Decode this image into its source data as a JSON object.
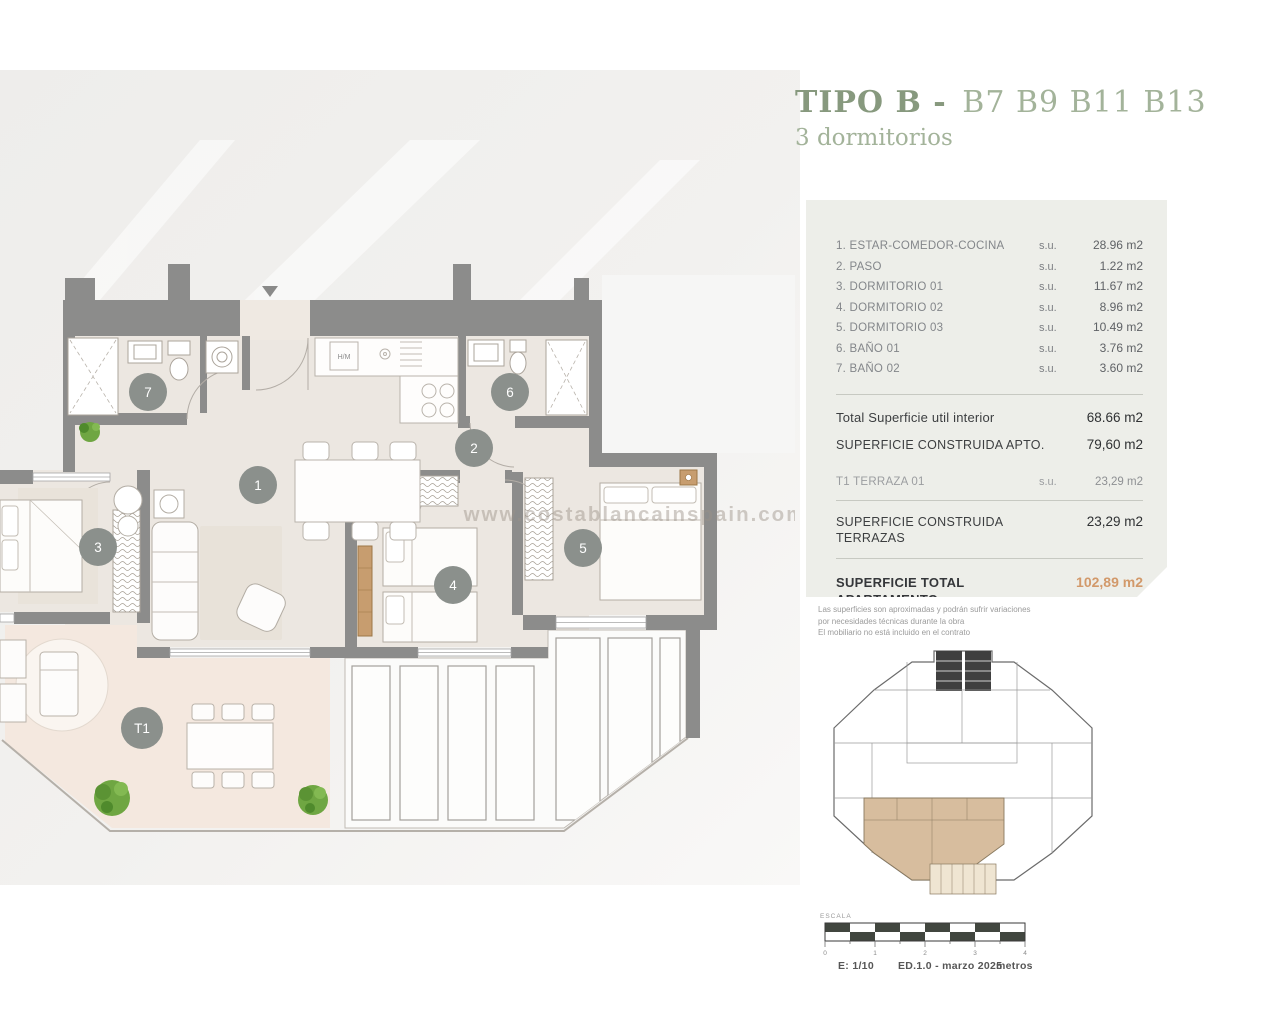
{
  "title": {
    "type_bold": "TIPO B -",
    "units": "B7 B9 B11 B13",
    "subtitle": "3 dormitorios"
  },
  "panel": {
    "rooms": [
      {
        "label": "1. ESTAR-COMEDOR-COCINA",
        "prefix": "s.u.",
        "value": "28.96 m2"
      },
      {
        "label": "2. PASO",
        "prefix": "s.u.",
        "value": "1.22 m2"
      },
      {
        "label": "3. DORMITORIO 01",
        "prefix": "s.u.",
        "value": "11.67 m2"
      },
      {
        "label": "4. DORMITORIO 02",
        "prefix": "s.u.",
        "value": "8.96 m2"
      },
      {
        "label": "5. DORMITORIO 03",
        "prefix": "s.u.",
        "value": "10.49 m2"
      },
      {
        "label": "6. BAÑO 01",
        "prefix": "s.u.",
        "value": "3.76 m2"
      },
      {
        "label": "7. BAÑO 02",
        "prefix": "s.u.",
        "value": "3.60 m2"
      }
    ],
    "total_util": {
      "label": "Total Superficie util interior",
      "value": "68.66 m2"
    },
    "construida_apto": {
      "label": "SUPERFICIE CONSTRUIDA APTO.",
      "value": "79,60 m2"
    },
    "terraza": {
      "label": "T1 TERRAZA 01",
      "prefix": "s.u.",
      "value": "23,29 m2"
    },
    "construida_terrazas": {
      "label": "SUPERFICIE CONSTRUIDA TERRAZAS",
      "value": "23,29 m2"
    },
    "total_apartamento": {
      "label": "SUPERFICIE TOTAL APARTAMENTO",
      "value": "102,89 m2"
    }
  },
  "disclaimer": {
    "line1": "Las superficies son aproximadas y podrán sufrir variaciones",
    "line2": "por necesidades técnicas durante la obra",
    "line3": "El mobiliario no está incluido en el contrato"
  },
  "plan": {
    "watermark": "www.costablancainspain.com",
    "kitchen_label": "H/M",
    "markers": {
      "m1": "1",
      "m2": "2",
      "m3": "3",
      "m4": "4",
      "m5": "5",
      "m6": "6",
      "m7": "7",
      "t1": "T1"
    }
  },
  "scalebar": {
    "caption": "ESCALA",
    "ticks": [
      "0",
      "1",
      "2",
      "3",
      "4"
    ],
    "scale": "E: 1/10",
    "edition": "ED.1.0 - marzo 2025",
    "unit": "metros"
  },
  "colors": {
    "accent_green": "#8fa486",
    "accent_orange": "#d2996a",
    "wall_gray": "#8c8c8b",
    "floor_beige": "#ece7e1",
    "terrace_pink": "#f4e8df",
    "panel_bg": "#edeee9",
    "highlight_tan": "#d7bd9e"
  }
}
